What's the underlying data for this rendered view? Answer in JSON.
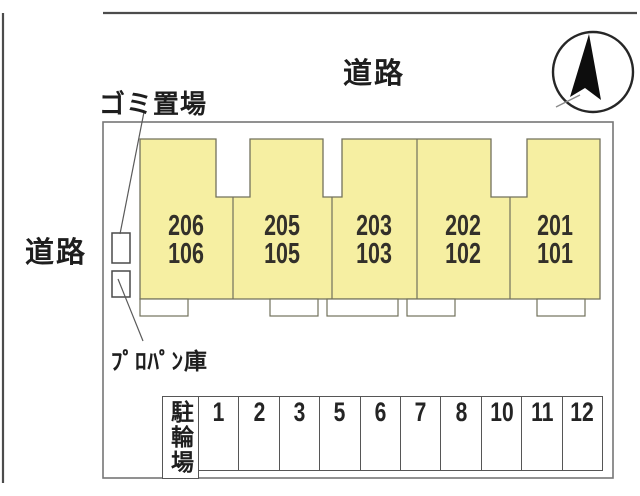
{
  "canvas": {
    "width": 640,
    "height": 496,
    "background": "#ffffff"
  },
  "colors": {
    "building_fill": "#f6efa2",
    "building_outline": "#72715c",
    "site_boundary": "#767676",
    "road_line": "#4c4c4c",
    "cell_border": "#565656",
    "text": "#1e1e1e",
    "unit_text": "#33302a",
    "compass_needle": "#0d0d0d"
  },
  "labels": {
    "road_top": "道路",
    "road_left": "道路",
    "garbage": "ゴミ置場",
    "propane": "ﾌﾟﾛﾊﾟﾝ庫"
  },
  "building": {
    "units": [
      {
        "upper": "206",
        "lower": "106"
      },
      {
        "upper": "205",
        "lower": "105"
      },
      {
        "upper": "203",
        "lower": "103"
      },
      {
        "upper": "202",
        "lower": "102"
      },
      {
        "upper": "201",
        "lower": "101"
      }
    ]
  },
  "bike_parking": {
    "label": "駐輪場",
    "spaces": [
      "1",
      "2",
      "3",
      "5",
      "6",
      "7",
      "8",
      "10",
      "11",
      "12"
    ]
  }
}
